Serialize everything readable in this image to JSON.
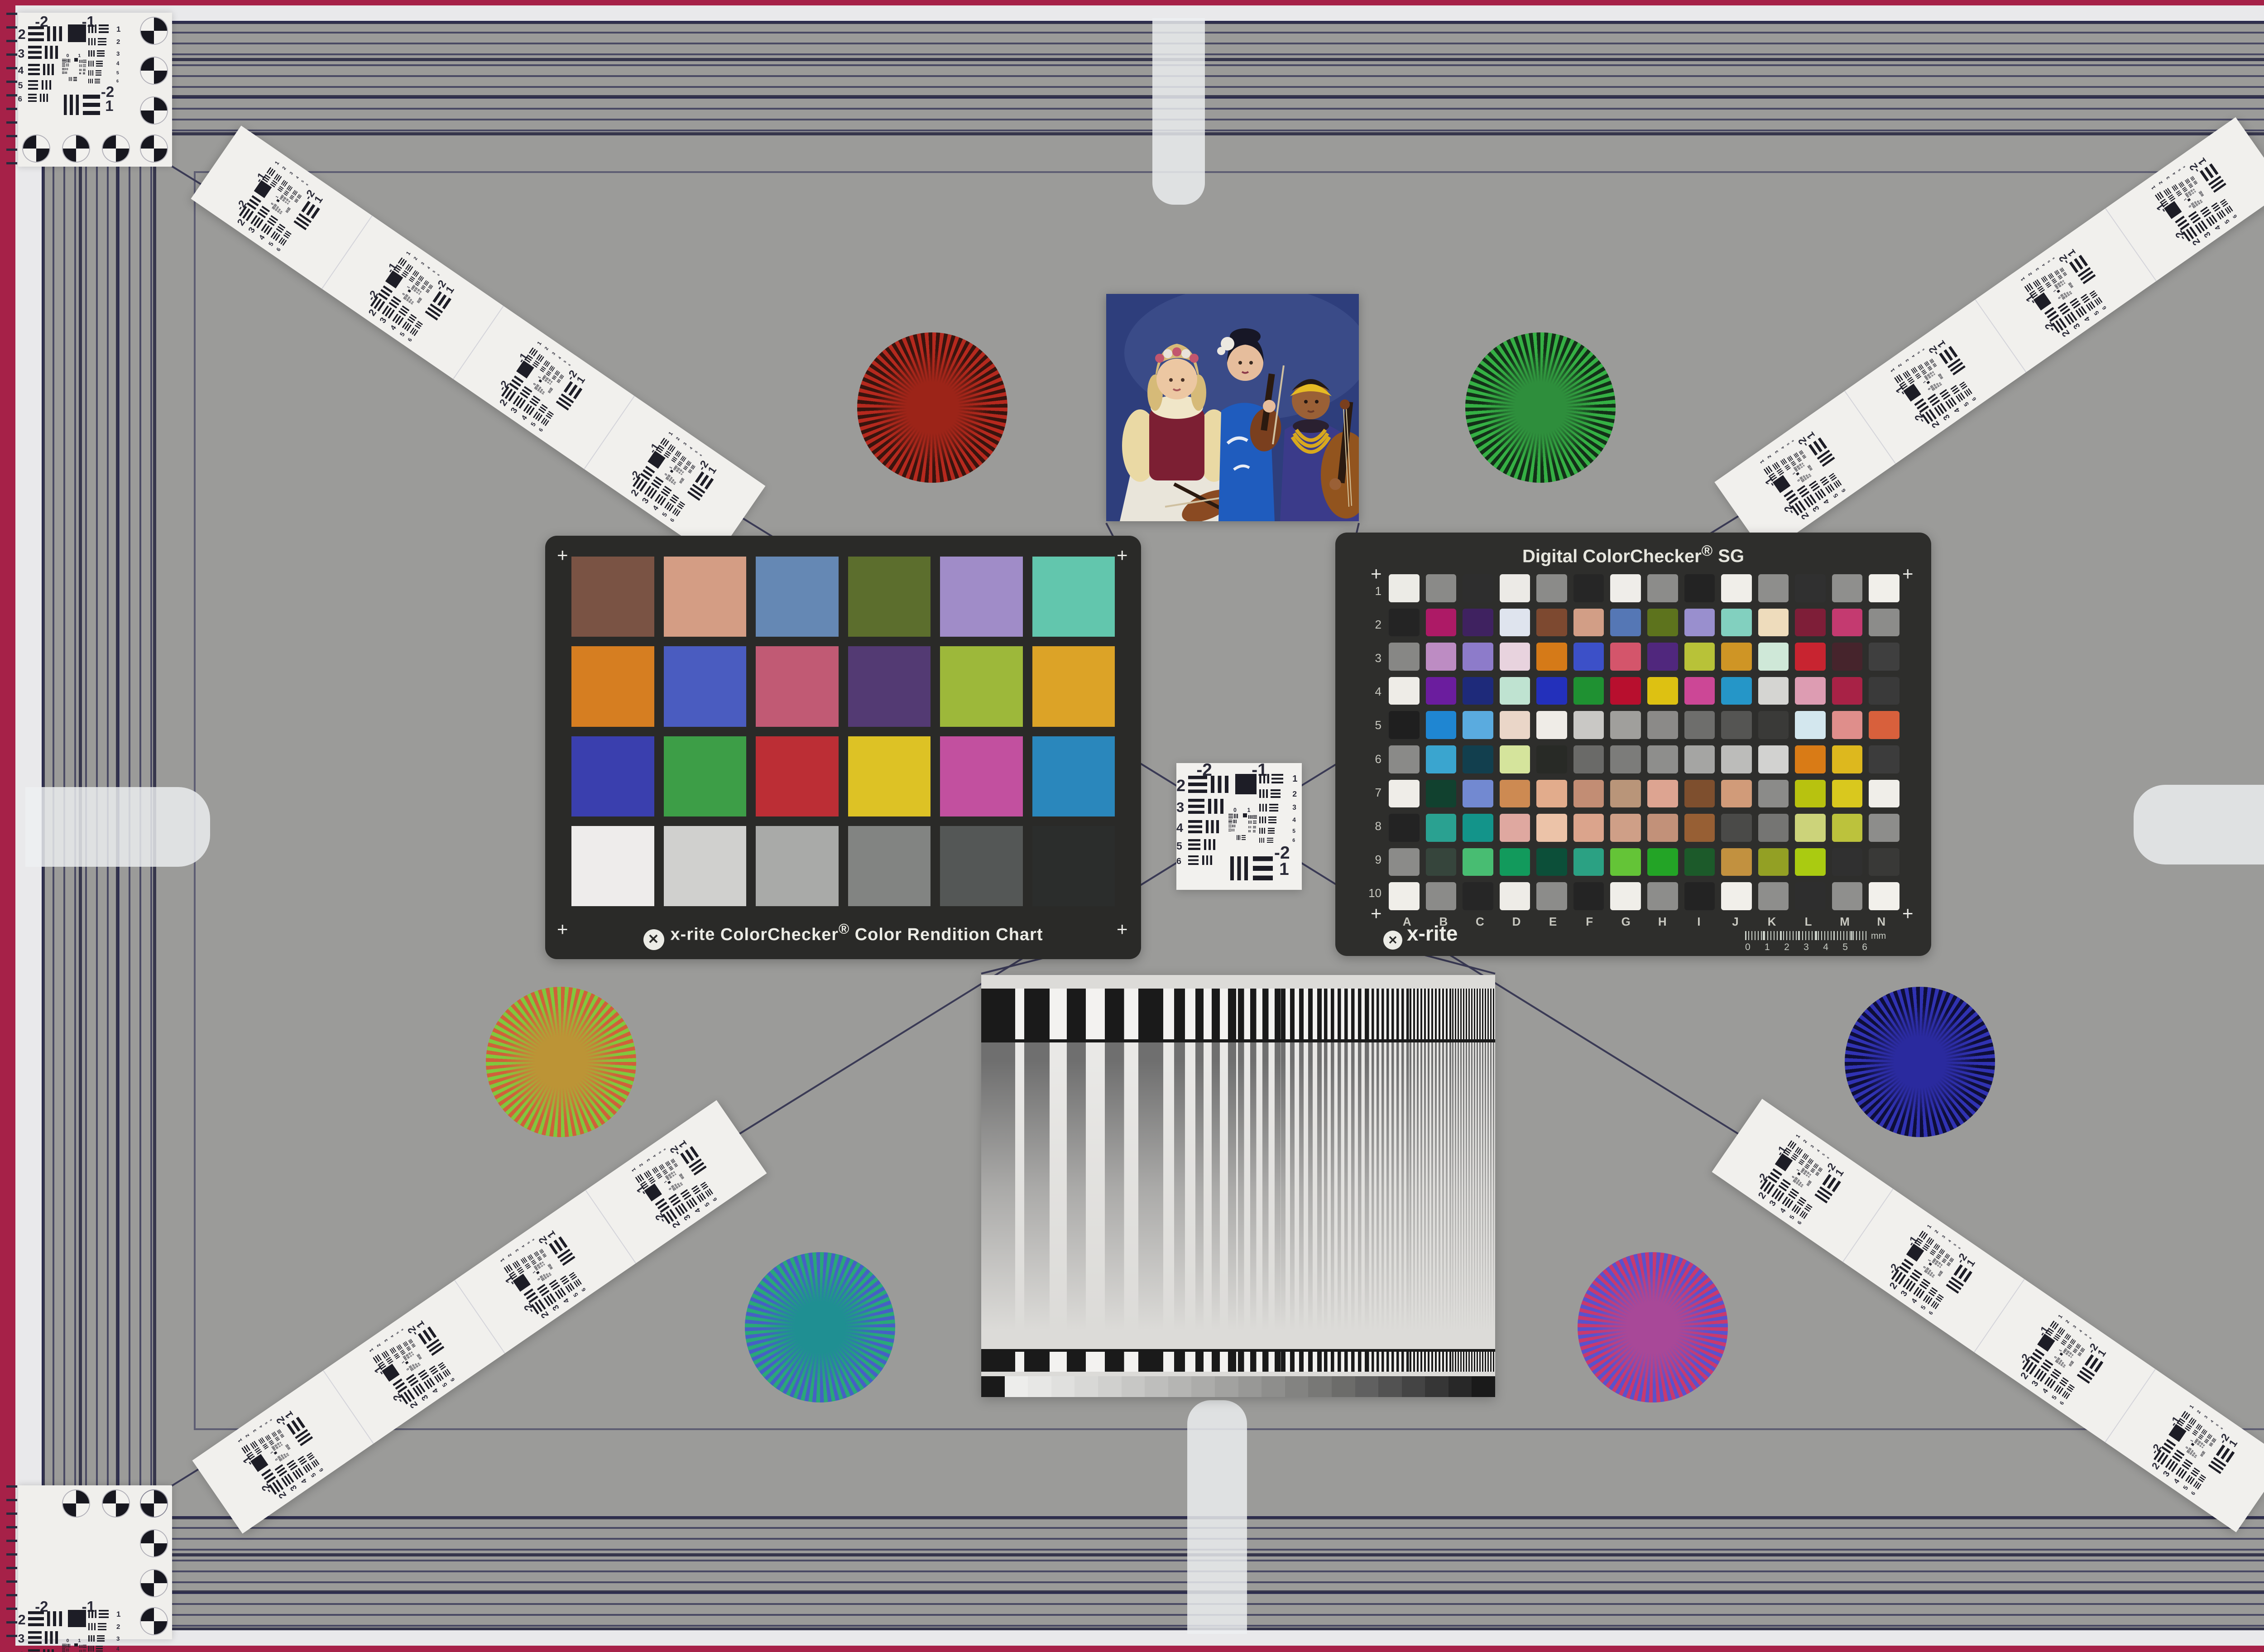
{
  "scene": {
    "field_bg": "#9b9b99",
    "rim_outer": "#a62148",
    "rim_strip": "#e9e9eb",
    "stripe_line": "#2c2c54",
    "tab_fill": "rgba(238,240,242,0.82)",
    "diagonal_line": "#3a3a55"
  },
  "usaf": {
    "top_labels": [
      "-2",
      "-1"
    ],
    "left_labels": [
      "2",
      "3",
      "4",
      "5",
      "6"
    ],
    "right_labels": [
      "1",
      "2",
      "3",
      "4",
      "5",
      "6"
    ],
    "bottom_labels": [
      "-2",
      "1"
    ],
    "center_labels": [
      "0",
      "1"
    ],
    "ink": "#1d1d26",
    "card_bg": "#f2f1ee"
  },
  "colorchecker24": {
    "card_bg": "#2a2a28",
    "label": {
      "logo_glyph": "✕",
      "brand": "x-rite",
      "product": "ColorChecker",
      "reg": "®",
      "rest": "Color Rendition Chart"
    },
    "patch_rows": [
      [
        "#7a5344",
        "#d49d84",
        "#6588b4",
        "#5c6e2d",
        "#a08cc8",
        "#62c6ad"
      ],
      [
        "#d67e21",
        "#4a5cc0",
        "#c15a74",
        "#533a73",
        "#9db83a",
        "#dca327"
      ],
      [
        "#3a3fae",
        "#3d9e47",
        "#bc2e35",
        "#ddc225",
        "#c2509f",
        "#2a87bc"
      ],
      [
        "#eeeceb",
        "#d0d0ce",
        "#a9aaa8",
        "#828482",
        "#545756",
        "#2b2d2c"
      ]
    ]
  },
  "sg": {
    "card_bg": "#2e2e2c",
    "title_main": "Digital ColorChecker",
    "title_reg": "®",
    "title_suffix": "SG",
    "logo_glyph": "✕",
    "logo_text": "x-rite",
    "row_labels": [
      "1",
      "2",
      "3",
      "4",
      "5",
      "6",
      "7",
      "8",
      "9",
      "10"
    ],
    "col_labels": [
      "A",
      "B",
      "C",
      "D",
      "E",
      "F",
      "G",
      "H",
      "I",
      "J",
      "K",
      "L",
      "M",
      "N"
    ],
    "ruler_numbers": [
      "0",
      "1",
      "2",
      "3",
      "4",
      "5",
      "6"
    ],
    "ruler_unit": "mm",
    "patch_rows": [
      [
        "#ecebe6",
        "#8a8a88",
        "#2e2e2e",
        "#eceae6",
        "#8b8b89",
        "#262626",
        "#efede9",
        "#8c8c8a",
        "#232323",
        "#f0eee9",
        "#8e8e8c",
        "#303030",
        "#8f8f8d",
        "#f1efea"
      ],
      [
        "#242424",
        "#ad1a66",
        "#3f2260",
        "#dfe4ee",
        "#7d4930",
        "#d29e86",
        "#5577b5",
        "#5d731d",
        "#998fce",
        "#82d0bf",
        "#eedcbc",
        "#7e1e38",
        "#c43a70",
        "#8c8c8a"
      ],
      [
        "#878785",
        "#bd8cc3",
        "#8d7bca",
        "#e8d3de",
        "#d57a18",
        "#3c50c8",
        "#d4556b",
        "#50277d",
        "#b8c238",
        "#cf9525",
        "#cfe8d8",
        "#c82430",
        "#46242c",
        "#3f3f3f"
      ],
      [
        "#eeece7",
        "#6b1d9e",
        "#1e2a7a",
        "#bfe3d1",
        "#2330bb",
        "#1f9132",
        "#b80f2e",
        "#ddc112",
        "#cc4796",
        "#2596c8",
        "#d5d5d2",
        "#dd9cb2",
        "#a82246",
        "#3a3a3a"
      ],
      [
        "#1f1f1f",
        "#1f86d2",
        "#5aabdf",
        "#ead6c8",
        "#efece7",
        "#c9c8c5",
        "#a09f9c",
        "#8b8a88",
        "#6e6e6c",
        "#555553",
        "#3a3a38",
        "#d3e7ee",
        "#df8e8b",
        "#d8603c"
      ],
      [
        "#8a8a88",
        "#3aa5cf",
        "#123f4e",
        "#d5e49c",
        "#282a26",
        "#6a6a68",
        "#7c7c7a",
        "#8e8e8c",
        "#a5a5a3",
        "#bcbcba",
        "#d2d2d0",
        "#d97b16",
        "#ddb81e",
        "#3c3c3c"
      ],
      [
        "#efede8",
        "#11412f",
        "#7289d1",
        "#cd8a52",
        "#e2ac8c",
        "#c28d74",
        "#b99579",
        "#dda491",
        "#7e4f2e",
        "#d19b79",
        "#8b8b89",
        "#b8c20f",
        "#d9c81e",
        "#f0eee9"
      ],
      [
        "#232323",
        "#2aa191",
        "#13948a",
        "#dfa8a0",
        "#ecc3a8",
        "#dba48c",
        "#cf9f87",
        "#c29179",
        "#975f34",
        "#4a4a48",
        "#757573",
        "#ccd37a",
        "#bcc23c",
        "#8d8d8b"
      ],
      [
        "#8b8b89",
        "#36453c",
        "#48bd72",
        "#129a5c",
        "#0c4f39",
        "#2ba183",
        "#64c437",
        "#23a426",
        "#1c5a2a",
        "#c2913f",
        "#93a024",
        "#aacb11",
        "#303030",
        "#393937"
      ],
      [
        "#f0eee9",
        "#8b8b89",
        "#262626",
        "#eeece7",
        "#8c8c8a",
        "#242424",
        "#f0eee9",
        "#8d8d8b",
        "#232323",
        "#f1efea",
        "#8e8e8c",
        "#2e2e2e",
        "#8f8f8d",
        "#f2f0eb"
      ]
    ]
  },
  "stars": [
    {
      "name": "red-black",
      "a": "#b5291e",
      "b": "#38140e",
      "center": "#9c2418"
    },
    {
      "name": "green-black",
      "a": "#35b044",
      "b": "#133018",
      "center": "#2e8e3c"
    },
    {
      "name": "red-green",
      "a": "#d0603a",
      "b": "#80c83e",
      "center": "#bc9436"
    },
    {
      "name": "blue-black",
      "a": "#3032b2",
      "b": "#0e0e38",
      "center": "#2a2a9e"
    },
    {
      "name": "green-blue",
      "a": "#2aa878",
      "b": "#4660c4",
      "center": "#1f8f92"
    },
    {
      "name": "red-blue",
      "a": "#c83a6e",
      "b": "#5a52cc",
      "center": "#a84898"
    }
  ],
  "sweep": {
    "card_bg": "#dcdbd8",
    "bar_dark": "#1a1a1a",
    "bar_light": "#f3f2f0",
    "stripe_dark": "#6f6f6f",
    "stripe_light": "#e9e8e6",
    "pair_widths": [
      150,
      112,
      84,
      63,
      48,
      36,
      27,
      20,
      15,
      11,
      8,
      6
    ],
    "gray_steps": [
      "#1a1a1a",
      "#ededeb",
      "#e7e7e5",
      "#e0e0de",
      "#d8d8d6",
      "#d0d0ce",
      "#c7c7c5",
      "#bebebc",
      "#b5b5b3",
      "#acacaa",
      "#a2a2a0",
      "#989896",
      "#8e8e8c",
      "#838381",
      "#787876",
      "#6c6c6a",
      "#606060",
      "#525252",
      "#444444",
      "#363636",
      "#282828",
      "#1a1a1a"
    ]
  },
  "portrait": {
    "palette": {
      "bg": "#2e3e7c",
      "bglight": "#4a5a96",
      "skirt": "#e9e5da",
      "vest": "#7c1f33",
      "blouse": "#ead9a4",
      "collar": "#f0e6c8",
      "skin1": "#ecc7a2",
      "hair1": "#d6ba78",
      "flower_pink": "#c2566e",
      "flower_white": "#e9e2da",
      "kimono": "#1f5cbe",
      "crane": "#e8ecf4",
      "skin2": "#e6bd9c",
      "hair2": "#171726",
      "violin_light": "#8a4a22",
      "violin_dark": "#7a3f1e",
      "fingerboard": "#2a1a10",
      "robe": "#3b3b8a",
      "skin3": "#9a6036",
      "band": "#e6bb24",
      "hair3": "#241a14",
      "beads": "#d8a81e",
      "cello": "#92541e",
      "bow": "#cfc0a0",
      "scarf": "#2a2030",
      "white_flower": "#ece8e0"
    }
  }
}
